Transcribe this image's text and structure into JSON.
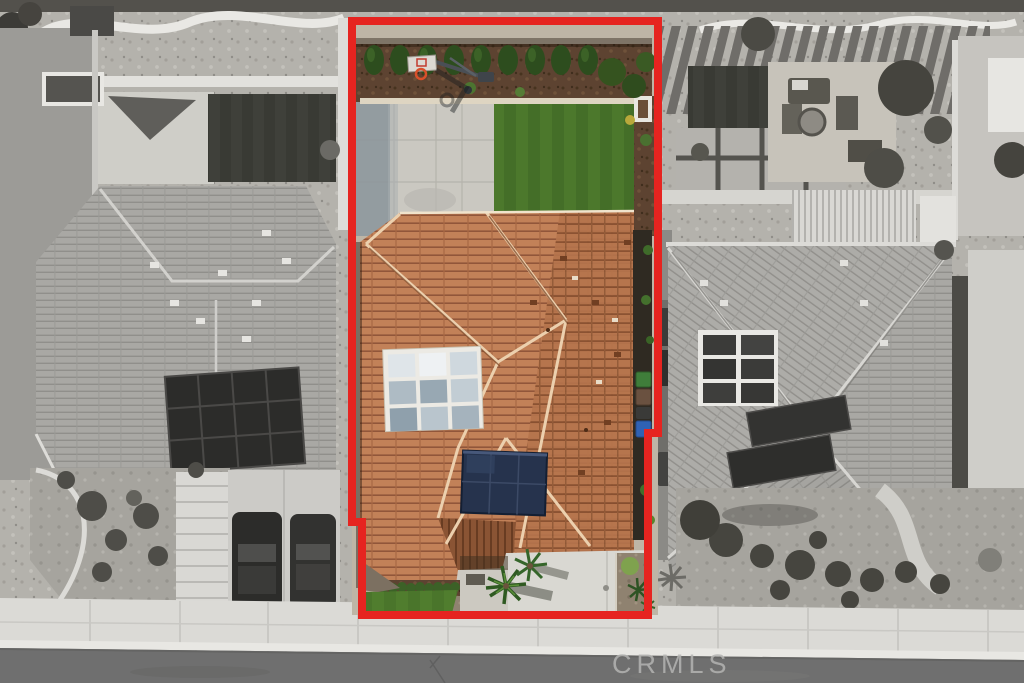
{
  "scene": {
    "type": "aerial-drone-photo",
    "description": "Overhead real-estate aerial photo; subject property shown in color and outlined in red, neighboring homes and street desaturated to grayscale"
  },
  "watermark": {
    "text": "CRMLS"
  },
  "colors": {
    "property_outline": "#e62420",
    "watermark_text": "#b4b4b2",
    "subject_roof_tile": "#c28158",
    "subject_roof_tile_line": "#91563a",
    "subject_lawn": "#4c782c",
    "solar_panel": "#26334d",
    "skylight_frame": "#eceae4",
    "backyard_concrete": "#cac8c1",
    "mulch_brown": "#5d4331",
    "cypress_green": "#2d4d1e",
    "trash_bin_green": "#3f7d3a",
    "trash_bin_blue": "#2f62b4",
    "trash_bin_brown": "#6a5140",
    "neighbor_roof_gray": "#a9a8a4",
    "neighbor_solar_dark": "#2c2c2a",
    "road_asphalt": "#6f6f6f",
    "sidewalk_concrete": "#dbdad6"
  }
}
